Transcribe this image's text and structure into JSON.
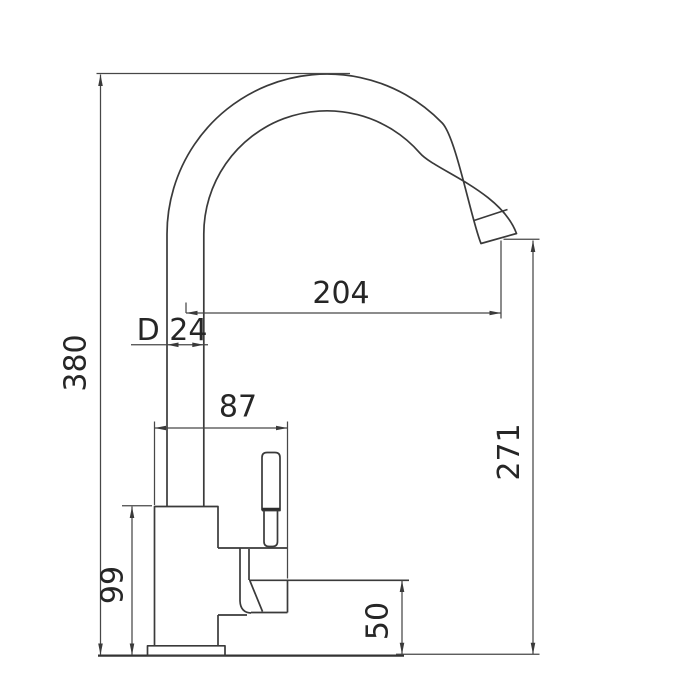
{
  "page": {
    "background_color": "#ffffff",
    "drawing_line_color": "#3a3a3a",
    "text_color": "#262626"
  },
  "drawing": {
    "dimensions": {
      "total_height": "380",
      "spout_reach": "204",
      "tube_diameter": "D 24",
      "handle_span": "87",
      "outlet_height": "271",
      "body_height": "99",
      "mount_height": "50"
    }
  }
}
